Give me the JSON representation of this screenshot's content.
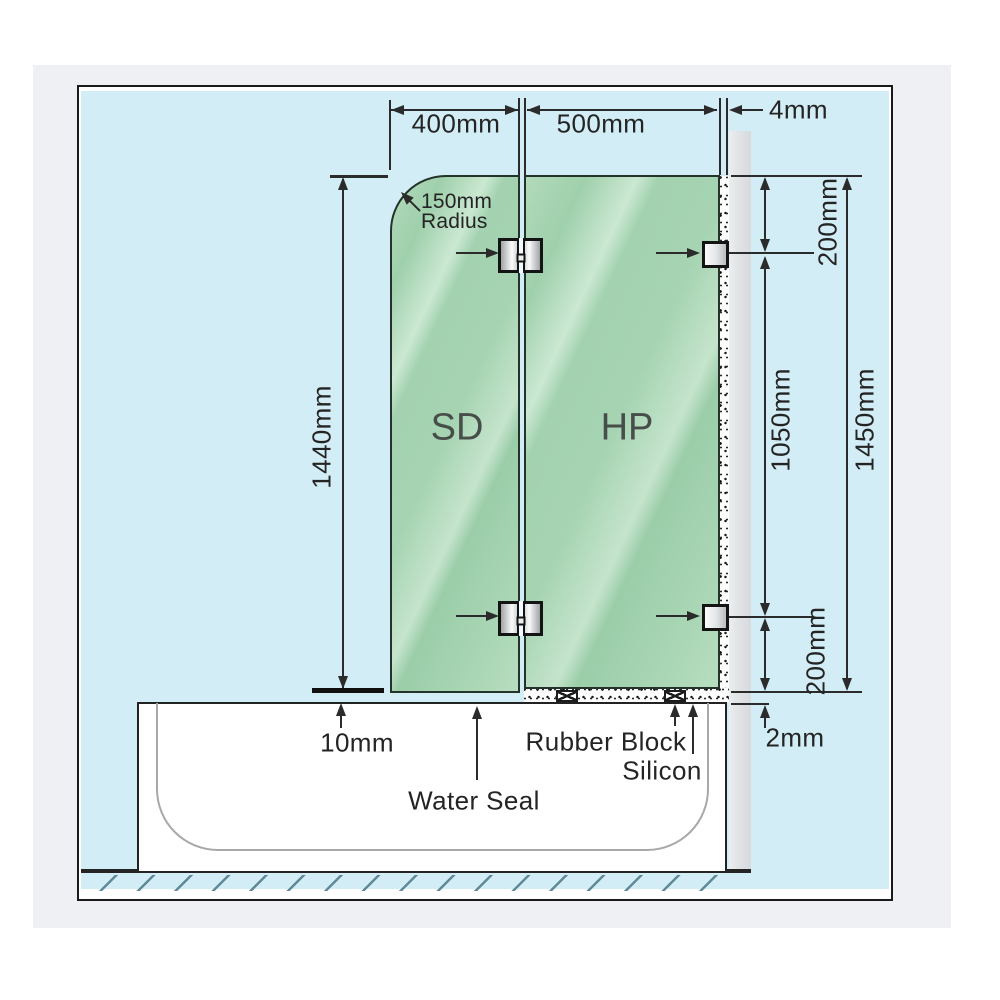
{
  "diagram_title": "frameless bath shower screen installation diagram",
  "colors": {
    "wall_blue": "#d2edf5",
    "glass_green": "#a6d4b2",
    "glass_highlight": "#cbe8d2",
    "frame_gray": "#eef0f3",
    "wall_channel_gray": "#e0e3e5",
    "line_dark": "#2b2b2b"
  },
  "panels": {
    "shower_door": "SD",
    "hinge_panel": "HP"
  },
  "dimensions": {
    "top": {
      "sd_width": "400mm",
      "hp_width": "500mm",
      "wall_gap": "4mm"
    },
    "left": {
      "door_height": "1440mm"
    },
    "right": {
      "top_bracket_offset": "200mm",
      "bracket_spacing": "1050mm",
      "panel_height": "1450mm",
      "bottom_bracket_offset": "200mm",
      "bottom_gap": "2mm"
    },
    "bottom": {
      "door_floor_gap": "10mm"
    }
  },
  "annotations": {
    "radius_value": "150mm",
    "radius_word": "Radius",
    "water_seal": "Water Seal",
    "rubber_block": "Rubber Block",
    "silicon": "Silicon"
  }
}
